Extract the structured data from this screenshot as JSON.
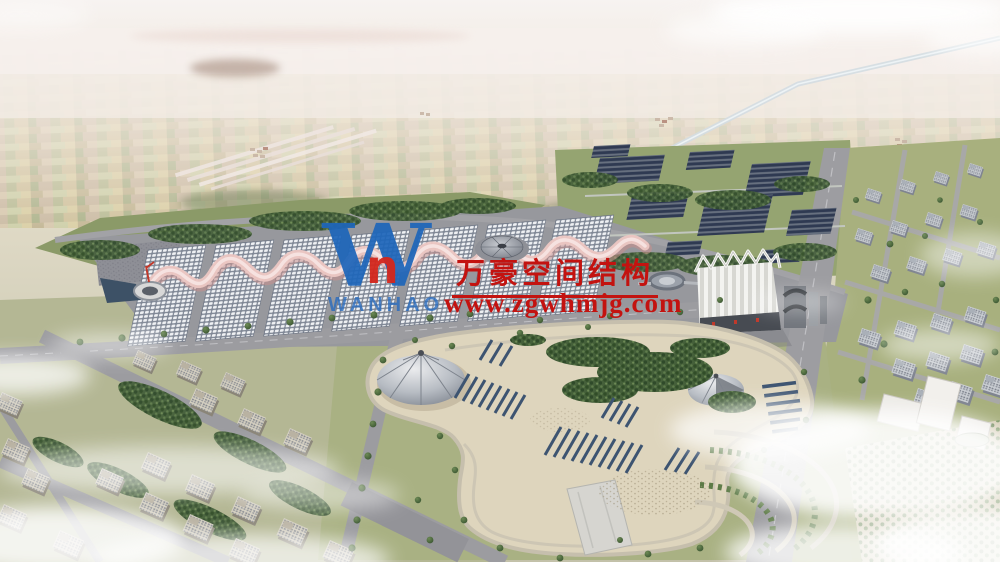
{
  "watermark": {
    "company_name": "万豪空间结构",
    "website": "www.zgwhmjg.com",
    "logo_glyph": "W",
    "logo_accent_glyph": "n",
    "logo_wordmark": "WANHAO",
    "colors": {
      "text_red": "#c31310",
      "logo_blue": "#1e66ba",
      "logo_red": "#d4271d"
    }
  },
  "scene": {
    "type": "aerial-architectural-rendering",
    "description": "Bird's-eye rendering of an exhibition-center campus: a row of gridshell exhibition halls joined by a pink wave canopy, a central dome, an oval pavilion, a white pleated conference hall, solar-panel arrays in parkland, a landscaped plaza with two tent canopies, residential blocks on both sides, and hazy farmland with a canal stretching to the horizon under wispy clouds.",
    "visible_elements": [
      "farmland-patchwork",
      "canal",
      "runway-strips",
      "forest-patch",
      "exhibition-halls",
      "pink-wave-canopy",
      "central-dome",
      "entry-rotunda",
      "pond",
      "oval-pavilion",
      "pleated-conference-hall",
      "solar-farm",
      "main-boulevard",
      "central-park",
      "tent-canopy-large",
      "tent-canopy-small",
      "tree-clusters",
      "terrace-steps",
      "stage-wedge",
      "left-residential-district",
      "right-residential-district",
      "tree-grid-plaza",
      "clouds"
    ]
  },
  "palette": {
    "sky_haze": "#f6f2f0",
    "farmland": "#d0c6a6",
    "greenery": "#5c7a46",
    "park_sand": "#ded5bd",
    "roof_grid": "#eef0f3",
    "canopy_pink": "#eec9c5",
    "solar_panel": "#2f3a52",
    "road_gray": "#9c9ca0"
  }
}
